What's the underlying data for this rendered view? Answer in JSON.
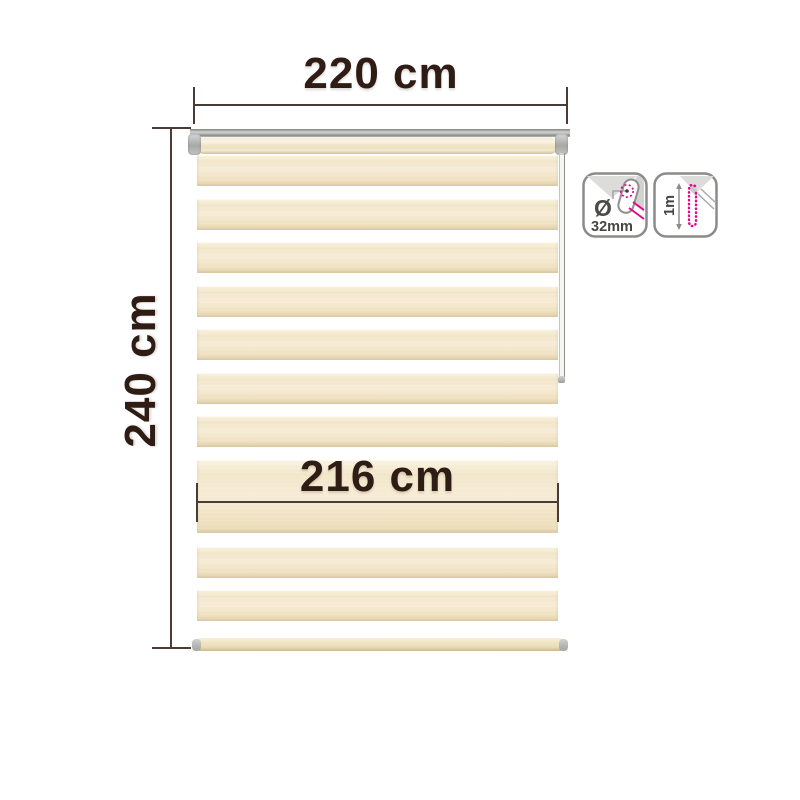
{
  "diagram": {
    "name": "roller-blind-dimension-diagram",
    "width_dimension": {
      "label": "220 cm"
    },
    "height_dimension": {
      "label": "240 cm"
    },
    "fabric_width_dimension": {
      "label": "216 cm"
    },
    "spec_icons": {
      "tube_diameter": {
        "symbol": "Ø",
        "value": "32mm"
      },
      "chain_length": {
        "value": "1m"
      }
    },
    "colors": {
      "background": "#ffffff",
      "dimension_text": "#2f1d15",
      "dimension_line": "#4a3b36",
      "fabric_cream": "#f2e6c9",
      "rail_gray": "#9aa09d",
      "accent_magenta": "#ec008c"
    }
  }
}
